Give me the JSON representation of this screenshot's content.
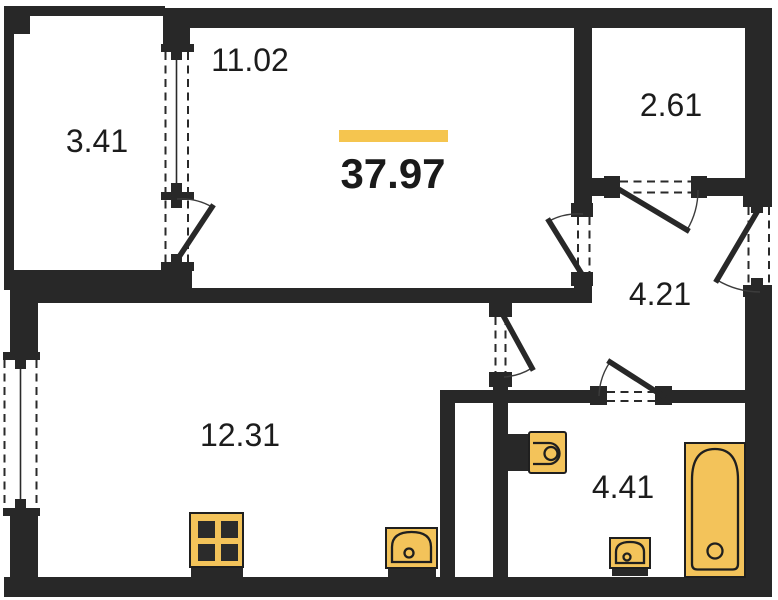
{
  "plan": {
    "title": "apartment-floor-plan",
    "total_area": {
      "label": "37.97"
    },
    "rooms": [
      {
        "id": "balcony",
        "area": "3.41"
      },
      {
        "id": "living-room",
        "area": "11.02"
      },
      {
        "id": "storage-room",
        "area": "2.61"
      },
      {
        "id": "hallway",
        "area": "4.21"
      },
      {
        "id": "kitchen-living-room",
        "area": "12.31"
      },
      {
        "id": "bathroom",
        "area": "4.41"
      }
    ],
    "fixtures": [
      "stove",
      "kitchen-sink",
      "toilet",
      "wash-basin",
      "bathtub"
    ],
    "colors": {
      "wall": "#282828",
      "background": "#ffffff",
      "fixture_fill": "#F3C35A",
      "highlight_bar": "#F5C54F",
      "label_text": "#1c1c1c"
    }
  }
}
